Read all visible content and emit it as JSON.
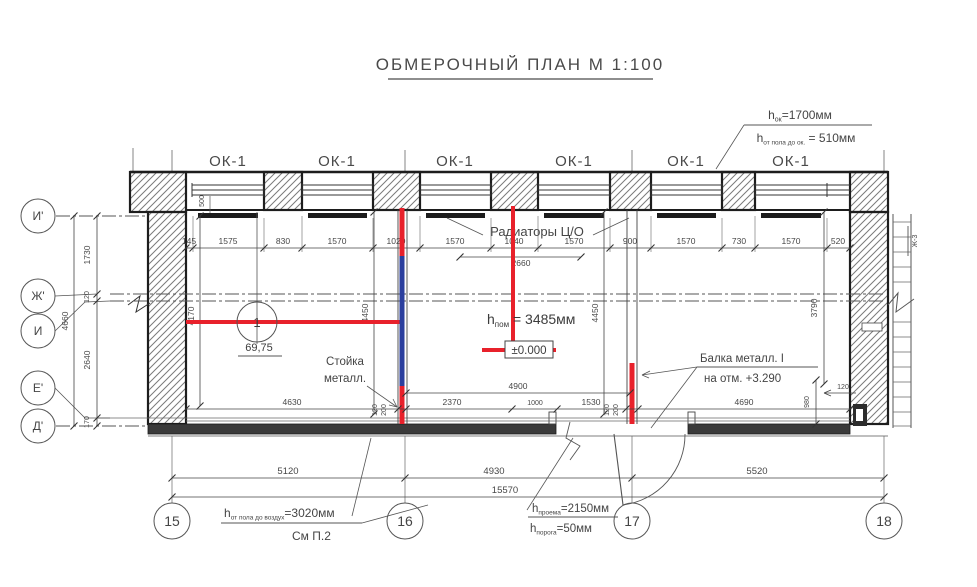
{
  "title": "ОБМЕРОЧНЫЙ ПЛАН  М 1:100",
  "colors": {
    "red": "#e8212b",
    "blue": "#2b3f9e",
    "ink": "#3c3c3c"
  },
  "windows": {
    "labels": [
      "ОК-1",
      "ОК-1",
      "ОК-1",
      "ОК-1",
      "ОК-1",
      "ОК-1"
    ]
  },
  "axes": {
    "left": [
      "И'",
      "Ж'",
      "И",
      "Е'",
      "Д'"
    ],
    "bottom": [
      "15",
      "16",
      "17",
      "18"
    ]
  },
  "ann": {
    "win_h": {
      "base": "h",
      "sub": "ок",
      "rest": "=1700мм"
    },
    "sill_h": {
      "base": "h",
      "sub": "от пола до ок.",
      "rest": " = 510мм"
    },
    "radiators": "Радиаторы Ц/О",
    "room_h": {
      "base": "h",
      "sub": "пом",
      "rest": " = 3485мм"
    },
    "zero": "±0.000",
    "mark_no": "1",
    "mark_elev": "69,75",
    "post_l1": "Стойка",
    "post_l2": "металл.",
    "beam_l1": "Балка металл. I",
    "beam_l2": "на отм. +3.290",
    "air_h": {
      "base": "h",
      "sub": "от пола до воздух",
      "rest": "=3020мм"
    },
    "see": "См П.2",
    "opening_h": {
      "base": "h",
      "sub": "проема",
      "rest": "=2150мм"
    },
    "threshold_h": {
      "base": "h",
      "sub": "порога",
      "rest": "=50мм"
    },
    "ladder": "Ж-3"
  },
  "dims": {
    "top": [
      "145",
      "1575",
      "830",
      "1570",
      "1020",
      "1570",
      "1040",
      "1570",
      "900",
      "1570",
      "730",
      "1570",
      "520"
    ],
    "under_top": "2660",
    "sill": "500",
    "left_chain": [
      "1730",
      "120",
      "2640",
      "170"
    ],
    "left_total": "4660",
    "vert_left": "4170",
    "vert_mid_a": "4450",
    "vert_mid_b": "4450",
    "vert_right": "3790",
    "right_980": "980",
    "right_120": "120",
    "post_a": [
      "120",
      "200"
    ],
    "post_b": [
      "120",
      "200"
    ],
    "floor": [
      "4630",
      "2370",
      "1000",
      "1530",
      "4690"
    ],
    "span_4900": "4900",
    "row1": [
      "5120",
      "4930",
      "5520"
    ],
    "total": "15570"
  }
}
